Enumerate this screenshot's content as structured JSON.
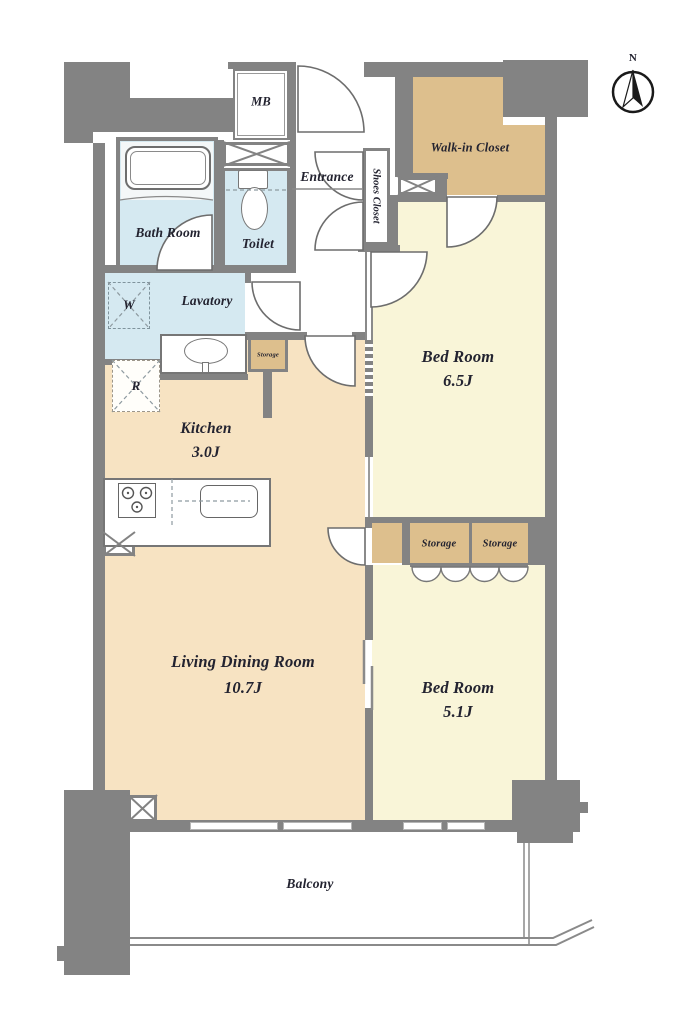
{
  "compass": {
    "north_label": "N"
  },
  "rooms": {
    "mb": "MB",
    "entrance": "Entrance",
    "shoes_closet": "Shoes Closet",
    "walk_in_closet": "Walk-in Closet",
    "bath_room": "Bath Room",
    "toilet": "Toilet",
    "lavatory": "Lavatory",
    "washer": "W",
    "refrigerator": "R",
    "storage_small": "Storage",
    "kitchen": {
      "name": "Kitchen",
      "area": "3.0J"
    },
    "bedroom_1": {
      "name": "Bed Room",
      "area": "6.5J"
    },
    "storage_1": "Storage",
    "storage_2": "Storage",
    "living_dining_room": {
      "name": "Living Dining Room",
      "area": "10.7J"
    },
    "bedroom_2": {
      "name": "Bed Room",
      "area": "5.1J"
    },
    "balcony": "Balcony"
  },
  "colors": {
    "wall": "#838383",
    "water_rooms": "#d5e9f1",
    "bedrooms": "#f9f5d8",
    "kitchen_living": "#f7e3c2",
    "closets": "#ddbf8d",
    "label_text": "#232330"
  }
}
